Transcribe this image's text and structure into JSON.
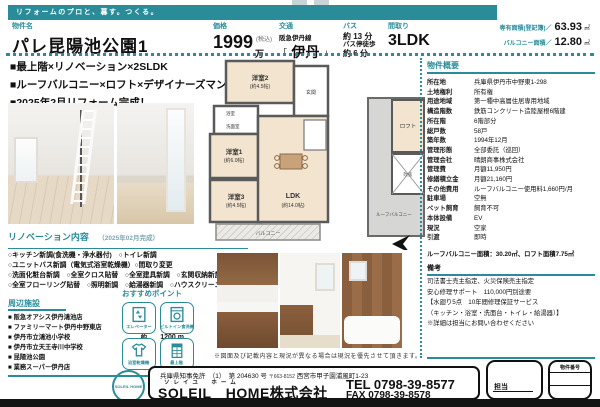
{
  "colors": {
    "accent": "#2b8c99",
    "bottom_bar": "#141414"
  },
  "banner": {
    "tagline": "リフォームのプロと、暮す。つくる。"
  },
  "header": {
    "property_label": "物件名",
    "property_name": "パレ昆陽池公園1",
    "price_label": "価格",
    "price_value": "1999",
    "price_tax": "(税込)",
    "price_unit": "万円",
    "transport_label": "交通",
    "transport_line": "阪急伊丹線",
    "station_open": "「",
    "station": "伊丹",
    "station_close": "」",
    "bus_label": "バス",
    "bus_time": "約 13 分",
    "bus_walk_label": "バス停徒歩",
    "bus_walk_time": "約 6 分",
    "layout_label": "間取り",
    "layout_value": "3LDK",
    "area_label": "専有面積(登記簿)／",
    "area_value": "63.93",
    "area_unit": "㎡",
    "balcony_label": "バルコニー面積／",
    "balcony_value": "12.80",
    "balcony_unit": "㎡"
  },
  "highlights": [
    "■最上階×リノベーション×2SLDK",
    "■ルーフバルコニー×ロフト×デザイナーズマンション",
    "■2025年2月リフォーム完成！"
  ],
  "renovation": {
    "title": "リノベーション内容",
    "subtitle": "（2025年02月完成）",
    "lines": [
      "○キッチン新調(食洗機・浄水器付)　○トイレ新調",
      "○ユニットバス新調（電気式浴室乾燥機）○間取り変更",
      "○洗面化粧台新調　○全室クロス貼替　○全室建具新調　○玄関収納新設",
      "○全室フローリング貼替　○照明新調　○給湯器新調　○ハウスクリーニング"
    ]
  },
  "facilities": {
    "title": "周辺施設",
    "dots": "…",
    "approx": "約",
    "items": [
      {
        "name": "阪急オアシス伊丹鴻池店",
        "distance": "960 m"
      },
      {
        "name": "ファミリーマート伊丹中野東店",
        "distance": "350 m"
      },
      {
        "name": "伊丹市立鴻池小学校",
        "distance": "1200 m"
      },
      {
        "name": "伊丹市立天王寺川中学校",
        "distance": "880 m"
      },
      {
        "name": "昆陽池公園",
        "distance": "400 m"
      },
      {
        "name": "業務スーパー伊丹店",
        "distance": "450 m"
      }
    ]
  },
  "points": {
    "title": "おすすめポイント",
    "items": [
      {
        "label": "エレベーター",
        "icon": "elevator-icon"
      },
      {
        "label": "ビルトイン食洗機",
        "icon": "dishwasher-icon"
      },
      {
        "label": "浴室乾燥機",
        "icon": "bathroom-dryer-icon"
      },
      {
        "label": "最上階",
        "icon": "top-floor-icon"
      }
    ]
  },
  "floorplan": {
    "room2": "洋室2",
    "room2_size": "(約4.5帖)",
    "room1": "洋室1",
    "room1_size": "(約6.0帖)",
    "room3": "洋室3",
    "room3_size": "(約4.5帖)",
    "ldk": "LDK",
    "ldk_size": "(約14.0帖)",
    "entrance": "玄関",
    "bath": "浴室",
    "wash": "洗面室",
    "balcony": "バルコニー",
    "roof_balcony": "ルーフバルコニー",
    "loft": "ロフト",
    "void": "吹抜"
  },
  "photos_caption": "※図面及び記載内容と現況が異なる場合は現況を優先させて頂きます。",
  "overview": {
    "title": "物件概要",
    "rows": [
      {
        "label": "所在地",
        "value": "兵庫県伊丹市中野東1-298"
      },
      {
        "label": "土地権利",
        "value": "所有権"
      },
      {
        "label": "用途地域",
        "value": "第一種中高層住居専用地域"
      },
      {
        "label": "構造階数",
        "value": "鉄筋コンクリート造陸屋根6階建"
      },
      {
        "label": "所在階",
        "value": "6階部分"
      },
      {
        "label": "総戸数",
        "value": "58戸"
      },
      {
        "label": "築年数",
        "value": "1994年12月"
      },
      {
        "label": "管理形態",
        "value": "全部委託（巡回）"
      },
      {
        "label": "管理会社",
        "value": "晴朗商事株式会社"
      },
      {
        "label": "管理費",
        "value": "月額11,950円"
      },
      {
        "label": "修繕積立金",
        "value": "月額21,160円"
      },
      {
        "label": "その他費用",
        "value": "ルーフバルコニー使用料1,660円/月"
      },
      {
        "label": "駐車場",
        "value": "空無"
      },
      {
        "label": "ペット飼育",
        "value": "飼育不可"
      },
      {
        "label": "本体設備",
        "value": "EV"
      },
      {
        "label": "現況",
        "value": "空家"
      },
      {
        "label": "引渡",
        "value": "即時"
      }
    ],
    "area_note": "ルーフバルコニー面積：30.20㎡、ロフト面積7.75㎡",
    "remarks_title": "備考",
    "remarks": [
      "司法書士売主指定、火災保険売主指定",
      "安心修理サポート　110,000円別途要",
      "【水廻り5点　10年間修理保証サービス",
      "（キッチン・浴室・洗面台・トイレ・給湯器）】",
      "※詳細は担当にお問い合わせください"
    ]
  },
  "footer": {
    "license": "兵庫県知事免許　（1）　第 204630 号",
    "postal": "〒663-8152",
    "address": "西宮市甲子園浦風町1-23",
    "furigana": "ソレイユ　ホーム",
    "company": "SOLEIL　HOME株式会社",
    "tel": "TEL 0798-39-8577",
    "fax": "FAX 0798-39-8578",
    "staff_label": "担当",
    "property_no_label": "物件番号",
    "logo_text": "SOLEIL HOME"
  }
}
